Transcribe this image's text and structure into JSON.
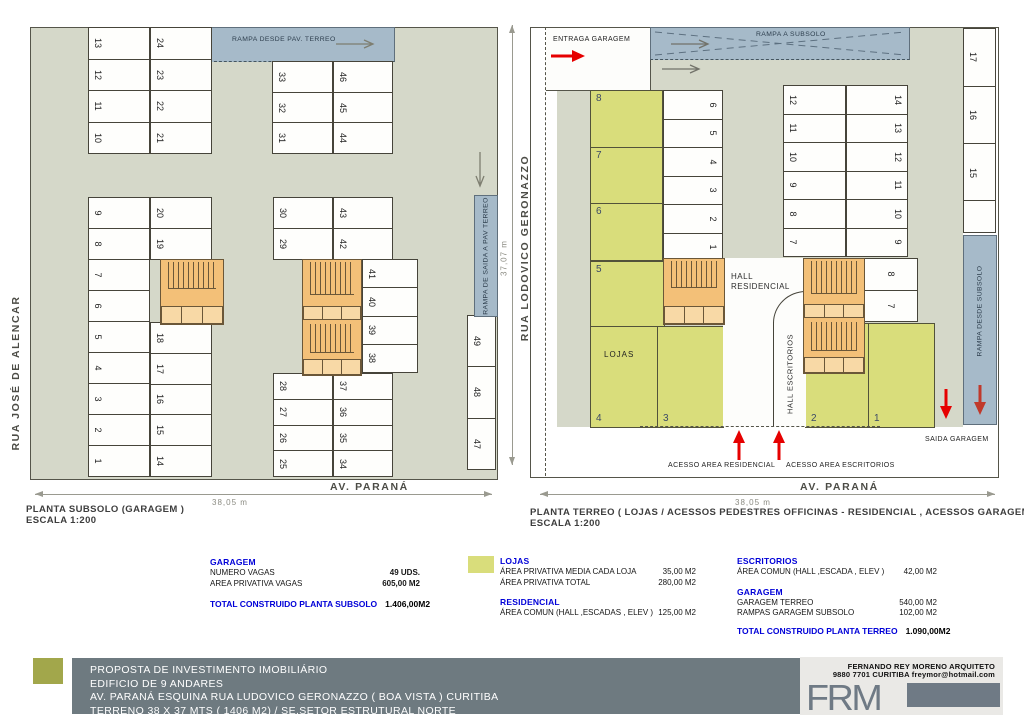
{
  "colors": {
    "driveway": "#d5d8c9",
    "ramp_blue": "#a6bac9",
    "stair_orange": "#f3c078",
    "loja_yellow": "#d9dd7b",
    "accent_blue_text": "#0000d8",
    "arrow_red": "#e60000",
    "bar_gray": "#6e7a80",
    "logo_olive": "#a2a74b"
  },
  "left_plan": {
    "title": "PLANTA SUBSOLO  (GARAGEM )",
    "scale": "ESCALA 1:200",
    "street_left": "RUA JOSÉ DE ALENCAR",
    "street_bottom": "AV. PARANÁ",
    "dim_bottom": "38,05 m",
    "ramp_top_label": "RAMPA DESDE PAV. TERREO",
    "ramp_right_label": "RAMPA DE SAIDA A PAV TERREO",
    "stall_groups": {
      "a": [
        "13",
        "12",
        "11",
        "10"
      ],
      "b": [
        "24",
        "23",
        "22",
        "21"
      ],
      "c": [
        "33",
        "32",
        "31"
      ],
      "d": [
        "46",
        "45",
        "44"
      ],
      "e": [
        "9",
        "8",
        "7",
        "6",
        "5",
        "4",
        "3",
        "2",
        "1"
      ],
      "f": [
        "20",
        "19"
      ],
      "g": [
        "18",
        "17",
        "16",
        "15",
        "14"
      ],
      "h": [
        "30",
        "29"
      ],
      "i": [
        "28",
        "27",
        "26",
        "25"
      ],
      "j": [
        "43",
        "42"
      ],
      "k": [
        "37",
        "36",
        "35",
        "34"
      ],
      "l": [
        "41",
        "40",
        "39",
        "38"
      ],
      "m": [
        "49",
        "48",
        "47"
      ]
    }
  },
  "right_plan": {
    "title": "PLANTA TERREO ( LOJAS  / ACESSOS  PEDESTRES  OFFICINAS - RESIDENCIAL , ACESSOS GARAGEM   )",
    "scale": "ESCALA 1:200",
    "street_left": "RUA LODOVICO GERONAZZO",
    "street_bottom": "AV. PARANÁ",
    "dim_left": "37,07 m",
    "dim_bottom": "38,05 m",
    "entry_label": "ENTRAGA GARAGEM",
    "exit_label": "SAIDA GARAGEM",
    "ramp_top_label": "RAMPA A SUBSOLO",
    "ramp_right_label": "RAMPA DESDE SUBSOLO",
    "hall_res_line1": "HALL",
    "hall_res_line2": "RESIDENCIAL",
    "hall_esc": "HALL  ESCRITORIOS",
    "lojas_label": "LOJAS",
    "access_res": "ACESSO AREA  RESIDENCIAL",
    "access_esc": "ACESSO AREA  ESCRITORIOS",
    "stall_groups": {
      "a": [
        "6",
        "5",
        "4",
        "3",
        "2",
        "1"
      ],
      "b": [
        "12",
        "11",
        "10",
        "9",
        "8",
        "7"
      ],
      "c": [
        "14",
        "13",
        "12",
        "11",
        "10",
        "9"
      ],
      "d": [
        "17",
        "16",
        "15"
      ],
      "e": [
        "8",
        "7"
      ]
    },
    "lojas": {
      "col": [
        "8",
        "7",
        "6"
      ],
      "n5": "5",
      "n4": "4",
      "n3": "3",
      "n2": "2",
      "n1": "1"
    }
  },
  "legend": {
    "garagem_subsolo": {
      "title": "GARAGEM",
      "rows": [
        {
          "label": "NUMERO VAGAS",
          "value": "49 UDS."
        },
        {
          "label": "AREA PRIVATIVA VAGAS",
          "value": "605,00 M2"
        }
      ],
      "total_label": "TOTAL CONSTRUIDO PLANTA SUBSOLO",
      "total_value": "1.406,00M2"
    },
    "lojas": {
      "title": "LOJAS",
      "rows": [
        {
          "label": "ÁREA PRIVATIVA MEDIA CADA LOJA",
          "value": "35,00 M2"
        },
        {
          "label": "ÁREA PRIVATIVA TOTAL",
          "value": "280,00 M2"
        }
      ]
    },
    "residencial": {
      "title": "RESIDENCIAL",
      "rows": [
        {
          "label": "ÁREA COMUN (HALL ,ESCADAS , ELEV )",
          "value": "125,00 M2"
        }
      ]
    },
    "escritorios": {
      "title": "ESCRITORIOS",
      "rows": [
        {
          "label": "ÁREA COMUN (HALL ,ESCADA , ELEV )",
          "value": "42,00 M2"
        }
      ]
    },
    "garagem_terreo": {
      "title": "GARAGEM",
      "rows": [
        {
          "label": "GARAGEM TERREO",
          "value": "540,00 M2"
        },
        {
          "label": "RAMPAS GARAGEM SUBSOLO",
          "value": "102,00 M2"
        }
      ],
      "total_label": "TOTAL CONSTRUIDO PLANTA TERREO",
      "total_value": "1.090,00M2"
    }
  },
  "titleblock": {
    "line1": "PROPOSTA DE INVESTIMENTO IMOBILIÁRIO",
    "line2": "EDIFICIO DE 9 ANDARES",
    "line3": "AV. PARANÁ ESQUINA RUA LUDOVICO GERONAZZO   ( BOA VISTA ) CURITIBA",
    "line4": "TERRENO 38 X 37 MTS ( 1406 M2)    /  SE.SETOR ESTRUTURAL NORTE",
    "architect_line1": "FERNANDO REY MORENO       ARQUITETO",
    "architect_line2": "9880 7701     CURITIBA    freymor@hotmail.com",
    "logo_text": "FRM"
  }
}
